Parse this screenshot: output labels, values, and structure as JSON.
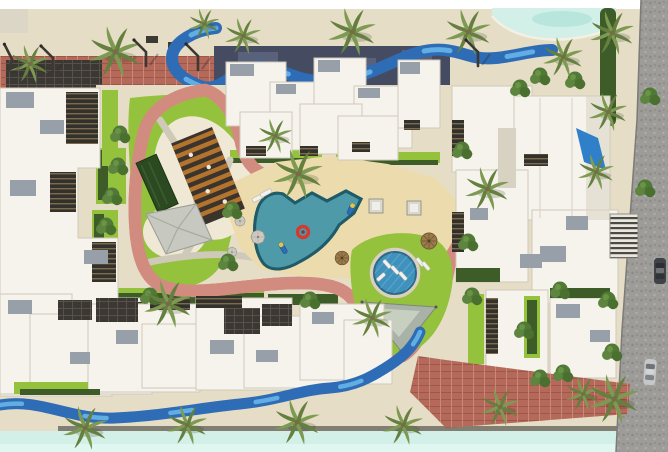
{
  "meta": {
    "description": "Aerial 3D masterplan rendering of a residential compound: white apartment clusters around a landscaped courtyard with free-form pool, round pool, pink jogging track, lazy river, palm trees, lagoon edges and a cobbled street with parked cars",
    "image_type": "architectural-site-render",
    "visible_text": ""
  },
  "palette": {
    "white": "#ffffff",
    "sand": "#e6ddc6",
    "sand_light": "#efe8d4",
    "deck": "#ecdcad",
    "lagoon": "#d2efe8",
    "lagoon_hi": "#e0f6f0",
    "lagoon_deep": "#b9e6dc",
    "river": "#2e6cb5",
    "river_hi": "#61aee4",
    "track": "#f4aba1",
    "track_edge": "#d28b7f",
    "lawn": "#95c23d",
    "lawn_dark": "#79a934",
    "hedge": "#3d5c28",
    "tree": "#517936",
    "palm1": "#7c9a52",
    "palm2": "#647f3e",
    "pool": "#4f9aa8",
    "pool_edge": "#1f5b68",
    "pool_round": "#3e92bd",
    "pool_round_edge": "#2a6a85",
    "building": "#f6f3ec",
    "building_shade": "#d8d2c2",
    "roof_gray": "#97a0a8",
    "band_dark": "#454c62",
    "band_hi": "#59617b",
    "panel": "#3b3834",
    "brick": "#b4695a",
    "brick_line": "#9c5747",
    "road": "#9d9c98",
    "wood": "#b5742e",
    "wood_dark": "#3a342c",
    "tent": "#c7c9c0",
    "tent_line": "#a9aba1",
    "sail": "#a9b2a6",
    "sail_light": "#ccd4c6",
    "float_red": "#d23b2f",
    "float_blue": "#2e6db6",
    "float_yellow": "#e8c53e",
    "lamp": "#3c3834",
    "path_gray": "#cfc9b9",
    "boardwalk": "#6f6e62"
  },
  "scene": {
    "palms": [
      {
        "x": 30,
        "y": 64,
        "s": 1.0
      },
      {
        "x": 115,
        "y": 52,
        "s": 1.35
      },
      {
        "x": 204,
        "y": 24,
        "s": 0.8
      },
      {
        "x": 243,
        "y": 36,
        "s": 0.95
      },
      {
        "x": 352,
        "y": 32,
        "s": 1.25
      },
      {
        "x": 468,
        "y": 32,
        "s": 1.2
      },
      {
        "x": 563,
        "y": 57,
        "s": 1.05
      },
      {
        "x": 612,
        "y": 33,
        "s": 1.15
      },
      {
        "x": 608,
        "y": 112,
        "s": 1.0
      },
      {
        "x": 596,
        "y": 172,
        "s": 0.95
      },
      {
        "x": 275,
        "y": 136,
        "s": 0.9
      },
      {
        "x": 298,
        "y": 174,
        "s": 1.3
      },
      {
        "x": 487,
        "y": 189,
        "s": 1.15
      },
      {
        "x": 168,
        "y": 304,
        "s": 1.25
      },
      {
        "x": 372,
        "y": 318,
        "s": 1.05
      },
      {
        "x": 85,
        "y": 428,
        "s": 1.15
      },
      {
        "x": 187,
        "y": 425,
        "s": 1.05
      },
      {
        "x": 297,
        "y": 422,
        "s": 1.2
      },
      {
        "x": 403,
        "y": 425,
        "s": 1.05
      },
      {
        "x": 500,
        "y": 407,
        "s": 1.0
      },
      {
        "x": 583,
        "y": 394,
        "s": 0.9
      },
      {
        "x": 614,
        "y": 399,
        "s": 1.3
      }
    ],
    "trees": [
      {
        "x": 118,
        "y": 166
      },
      {
        "x": 112,
        "y": 196
      },
      {
        "x": 106,
        "y": 226
      },
      {
        "x": 120,
        "y": 134
      },
      {
        "x": 232,
        "y": 210
      },
      {
        "x": 228,
        "y": 262
      },
      {
        "x": 462,
        "y": 150
      },
      {
        "x": 468,
        "y": 242
      },
      {
        "x": 472,
        "y": 296
      },
      {
        "x": 524,
        "y": 330
      },
      {
        "x": 560,
        "y": 290
      },
      {
        "x": 540,
        "y": 378
      },
      {
        "x": 563,
        "y": 373
      },
      {
        "x": 608,
        "y": 300
      },
      {
        "x": 645,
        "y": 188
      },
      {
        "x": 650,
        "y": 96
      },
      {
        "x": 520,
        "y": 88
      },
      {
        "x": 540,
        "y": 76
      },
      {
        "x": 575,
        "y": 80
      },
      {
        "x": 612,
        "y": 352
      },
      {
        "x": 150,
        "y": 296
      },
      {
        "x": 310,
        "y": 300
      }
    ],
    "street_lamps": [
      {
        "x": 14,
        "y": 60,
        "angle": 18
      },
      {
        "x": 55,
        "y": 58
      },
      {
        "x": 148,
        "y": 52
      },
      {
        "x": 200,
        "y": 56
      },
      {
        "x": 480,
        "y": 52
      }
    ],
    "cars": [
      {
        "x": 660,
        "y": 271,
        "color": "#3f4246"
      },
      {
        "x": 650,
        "y": 372,
        "angle": 4,
        "color": "#c6c7c9"
      }
    ],
    "umbrellas_gray": [
      {
        "x": 258,
        "y": 237
      },
      {
        "x": 240,
        "y": 221,
        "s": 0.75
      },
      {
        "x": 232,
        "y": 252,
        "s": 0.7
      }
    ],
    "umbrellas_tiki": [
      {
        "x": 429,
        "y": 241
      },
      {
        "x": 342,
        "y": 258,
        "s": 0.85
      }
    ],
    "cabanas": [
      {
        "x": 376,
        "y": 206
      },
      {
        "x": 414,
        "y": 208
      }
    ],
    "pool_rings": [
      {
        "x": 303,
        "y": 232
      }
    ],
    "pool_loungers": [
      {
        "x": 283,
        "y": 248,
        "angle": -30
      },
      {
        "x": 351,
        "y": 209,
        "angle": 24
      }
    ],
    "chairs": [
      {
        "x": 387,
        "y": 264,
        "angle": -42
      },
      {
        "x": 395,
        "y": 270,
        "angle": -42
      },
      {
        "x": 403,
        "y": 276,
        "angle": -42
      },
      {
        "x": 381,
        "y": 277,
        "angle": 48
      },
      {
        "x": 258,
        "y": 198,
        "angle": 62,
        "s": 1.2
      },
      {
        "x": 266,
        "y": 193,
        "angle": 62,
        "s": 1.2
      },
      {
        "x": 420,
        "y": 262,
        "angle": -40
      },
      {
        "x": 426,
        "y": 266,
        "angle": -40
      }
    ]
  }
}
